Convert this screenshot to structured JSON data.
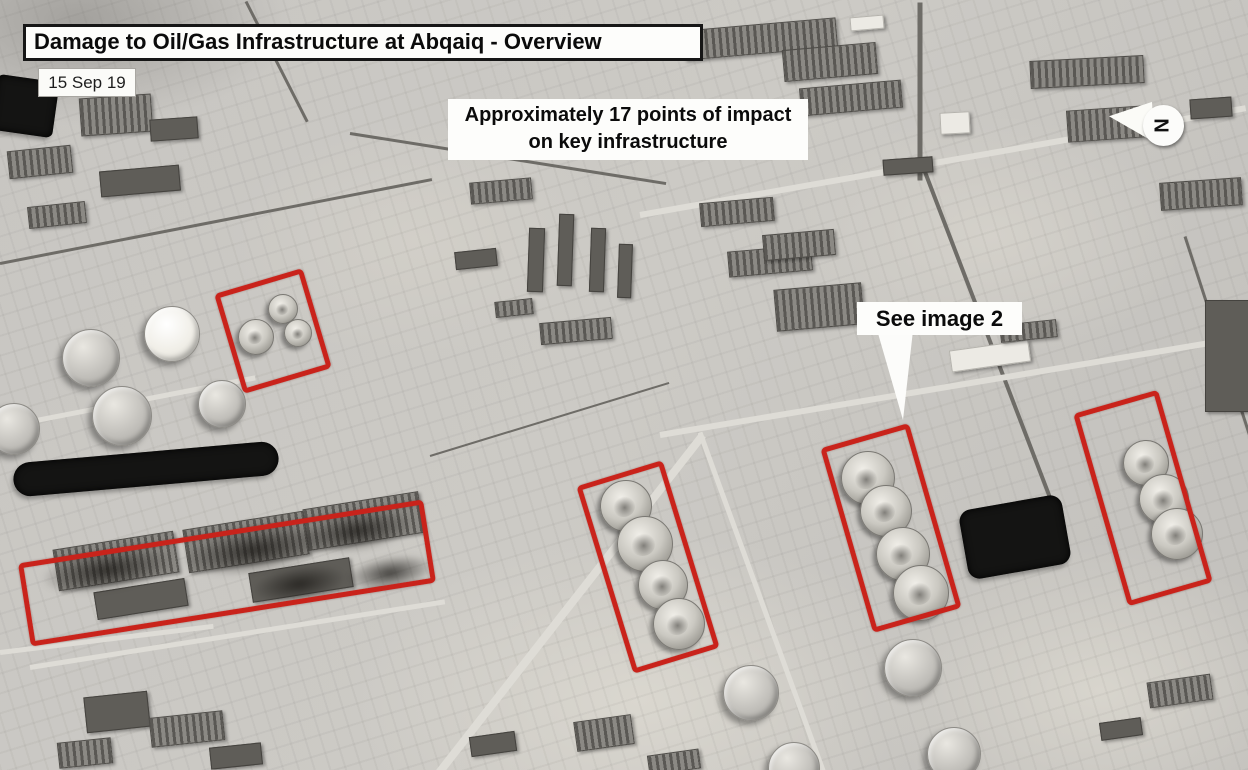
{
  "annotations": {
    "title": "Damage to Oil/Gas Infrastructure at Abqaiq - Overview",
    "date": "15 Sep 19",
    "impact_note_line1": "Approximately 17 points of impact",
    "impact_note_line2": "on key infrastructure",
    "see_image_label": "See image 2",
    "compass_letter": "N",
    "marker_color": "#c9231b"
  },
  "damage_markers": [
    {
      "id": "processing-area-northwest",
      "cx": 273,
      "cy": 331,
      "w": 92,
      "h": 104,
      "rot": -16.5
    },
    {
      "id": "stabilization-towers-row",
      "cx": 227,
      "cy": 573,
      "w": 410,
      "h": 84,
      "rot": -9
    },
    {
      "id": "spheroid-tanks-center",
      "cx": 648,
      "cy": 567,
      "w": 90,
      "h": 196,
      "rot": -17
    },
    {
      "id": "spheroid-tanks-east",
      "cx": 891,
      "cy": 528,
      "w": 92,
      "h": 192,
      "rot": -16
    },
    {
      "id": "spheroid-tanks-far-east",
      "cx": 1143,
      "cy": 498,
      "w": 88,
      "h": 200,
      "rot": -16
    }
  ],
  "scene": {
    "tanks": [
      {
        "x": 90,
        "y": 357,
        "r": 28
      },
      {
        "x": 171,
        "y": 333,
        "r": 27,
        "v": "bright"
      },
      {
        "x": 121,
        "y": 415,
        "r": 29
      },
      {
        "x": 221,
        "y": 403,
        "r": 23
      },
      {
        "x": 13,
        "y": 428,
        "r": 25
      },
      {
        "x": 750,
        "y": 692,
        "r": 27
      },
      {
        "x": 912,
        "y": 667,
        "r": 28
      },
      {
        "x": 953,
        "y": 753,
        "r": 26
      },
      {
        "x": 793,
        "y": 767,
        "r": 25
      }
    ],
    "domes": [
      {
        "x": 282,
        "y": 308,
        "r": 14
      },
      {
        "x": 255,
        "y": 336,
        "r": 17
      },
      {
        "x": 297,
        "y": 332,
        "r": 13
      },
      {
        "x": 625,
        "y": 505,
        "r": 25
      },
      {
        "x": 644,
        "y": 543,
        "r": 27
      },
      {
        "x": 662,
        "y": 584,
        "r": 24
      },
      {
        "x": 678,
        "y": 623,
        "r": 25
      },
      {
        "x": 867,
        "y": 477,
        "r": 26
      },
      {
        "x": 885,
        "y": 510,
        "r": 25
      },
      {
        "x": 902,
        "y": 553,
        "r": 26
      },
      {
        "x": 920,
        "y": 592,
        "r": 27
      },
      {
        "x": 1145,
        "y": 462,
        "r": 22
      },
      {
        "x": 1163,
        "y": 498,
        "r": 24
      },
      {
        "x": 1176,
        "y": 533,
        "r": 25
      }
    ],
    "ponds": [
      {
        "l": 13,
        "t": 452,
        "w": 266,
        "h": 34,
        "rot": -5,
        "br": 17
      },
      {
        "l": 963,
        "t": 502,
        "w": 104,
        "h": 70,
        "rot": -10,
        "br": 12
      },
      {
        "l": -6,
        "t": 78,
        "w": 62,
        "h": 56,
        "rot": 8,
        "br": 6
      }
    ],
    "smoke": [
      {
        "l": 40,
        "t": 548,
        "w": 135,
        "h": 44,
        "rot": -9
      },
      {
        "l": 180,
        "t": 526,
        "w": 150,
        "h": 48,
        "rot": -9
      },
      {
        "l": 300,
        "t": 510,
        "w": 115,
        "h": 42,
        "rot": -9
      },
      {
        "l": 252,
        "t": 566,
        "w": 95,
        "h": 36,
        "rot": -9
      },
      {
        "l": 345,
        "t": 556,
        "w": 90,
        "h": 34,
        "rot": -9
      }
    ],
    "buildings": [
      {
        "l": 80,
        "t": 96,
        "w": 70,
        "h": 36,
        "v": "striped",
        "rot": -4
      },
      {
        "l": 8,
        "t": 148,
        "w": 62,
        "h": 26,
        "v": "striped",
        "rot": -6
      },
      {
        "l": 100,
        "t": 168,
        "w": 78,
        "h": 24,
        "v": "dark",
        "rot": -5
      },
      {
        "l": 28,
        "t": 204,
        "w": 56,
        "h": 20,
        "v": "striped",
        "rot": -6
      },
      {
        "l": 150,
        "t": 118,
        "w": 46,
        "h": 20,
        "v": "dark",
        "rot": -4
      },
      {
        "l": 683,
        "t": 24,
        "w": 152,
        "h": 28,
        "v": "striped",
        "rot": -5
      },
      {
        "l": 783,
        "t": 46,
        "w": 92,
        "h": 30,
        "v": "striped",
        "rot": -5
      },
      {
        "l": 800,
        "t": 84,
        "w": 100,
        "h": 26,
        "v": "striped",
        "rot": -5
      },
      {
        "l": 850,
        "t": 16,
        "w": 32,
        "h": 12,
        "v": "light",
        "rot": -5
      },
      {
        "l": 700,
        "t": 200,
        "w": 72,
        "h": 22,
        "v": "striped",
        "rot": -5
      },
      {
        "l": 728,
        "t": 248,
        "w": 82,
        "h": 24,
        "v": "striped",
        "rot": -5
      },
      {
        "l": 775,
        "t": 286,
        "w": 86,
        "h": 40,
        "v": "striped",
        "rot": -5
      },
      {
        "l": 763,
        "t": 232,
        "w": 70,
        "h": 24,
        "v": "striped",
        "rot": -5
      },
      {
        "l": 528,
        "t": 228,
        "w": 14,
        "h": 62,
        "v": "dark",
        "rot": 2
      },
      {
        "l": 558,
        "t": 214,
        "w": 13,
        "h": 70,
        "v": "dark",
        "rot": 2
      },
      {
        "l": 590,
        "t": 228,
        "w": 13,
        "h": 62,
        "v": "dark",
        "rot": 2
      },
      {
        "l": 618,
        "t": 244,
        "w": 12,
        "h": 52,
        "v": "dark",
        "rot": 2
      },
      {
        "l": 540,
        "t": 320,
        "w": 70,
        "h": 20,
        "v": "striped",
        "rot": -5
      },
      {
        "l": 470,
        "t": 180,
        "w": 60,
        "h": 20,
        "v": "striped",
        "rot": -5
      },
      {
        "l": 455,
        "t": 250,
        "w": 40,
        "h": 16,
        "v": "dark",
        "rot": -6
      },
      {
        "l": 495,
        "t": 300,
        "w": 36,
        "h": 14,
        "v": "striped",
        "rot": -6
      },
      {
        "l": 1030,
        "t": 58,
        "w": 112,
        "h": 26,
        "v": "striped",
        "rot": -3
      },
      {
        "l": 1067,
        "t": 108,
        "w": 76,
        "h": 30,
        "v": "striped",
        "rot": -4
      },
      {
        "l": 940,
        "t": 112,
        "w": 28,
        "h": 20,
        "v": "light",
        "rot": -3
      },
      {
        "l": 883,
        "t": 158,
        "w": 48,
        "h": 14,
        "v": "dark",
        "rot": -4
      },
      {
        "l": 1160,
        "t": 180,
        "w": 80,
        "h": 26,
        "v": "striped",
        "rot": -4
      },
      {
        "l": 1205,
        "t": 300,
        "w": 44,
        "h": 110,
        "v": "dark",
        "rot": 0
      },
      {
        "l": 1190,
        "t": 98,
        "w": 40,
        "h": 18,
        "v": "dark",
        "rot": -4
      },
      {
        "l": 950,
        "t": 345,
        "w": 78,
        "h": 20,
        "v": "light",
        "rot": -8
      },
      {
        "l": 1000,
        "t": 322,
        "w": 55,
        "h": 16,
        "v": "striped",
        "rot": -6
      },
      {
        "l": 55,
        "t": 540,
        "w": 120,
        "h": 40,
        "v": "striped",
        "rot": -9
      },
      {
        "l": 185,
        "t": 520,
        "w": 120,
        "h": 42,
        "v": "striped",
        "rot": -9
      },
      {
        "l": 305,
        "t": 500,
        "w": 115,
        "h": 40,
        "v": "striped",
        "rot": -9
      },
      {
        "l": 95,
        "t": 585,
        "w": 90,
        "h": 26,
        "v": "dark",
        "rot": -9
      },
      {
        "l": 250,
        "t": 565,
        "w": 100,
        "h": 28,
        "v": "dark",
        "rot": -9
      },
      {
        "l": 85,
        "t": 694,
        "w": 62,
        "h": 34,
        "v": "dark",
        "rot": -6
      },
      {
        "l": 150,
        "t": 714,
        "w": 72,
        "h": 28,
        "v": "striped",
        "rot": -6
      },
      {
        "l": 58,
        "t": 740,
        "w": 52,
        "h": 24,
        "v": "striped",
        "rot": -6
      },
      {
        "l": 210,
        "t": 745,
        "w": 50,
        "h": 20,
        "v": "dark",
        "rot": -6
      },
      {
        "l": 470,
        "t": 734,
        "w": 44,
        "h": 18,
        "v": "dark",
        "rot": -8
      },
      {
        "l": 575,
        "t": 718,
        "w": 56,
        "h": 28,
        "v": "striped",
        "rot": -8
      },
      {
        "l": 648,
        "t": 752,
        "w": 50,
        "h": 18,
        "v": "striped",
        "rot": -8
      },
      {
        "l": 1148,
        "t": 678,
        "w": 62,
        "h": 24,
        "v": "striped",
        "rot": -8
      },
      {
        "l": 1100,
        "t": 720,
        "w": 40,
        "h": 16,
        "v": "dark",
        "rot": -8
      }
    ],
    "lines": [
      {
        "l": 0,
        "t": 262,
        "w": 440,
        "h": 3,
        "rot": -11,
        "v": "dark"
      },
      {
        "l": 350,
        "t": 132,
        "w": 320,
        "h": 3,
        "rot": 9,
        "v": "dark"
      },
      {
        "l": 920,
        "t": 0,
        "w": 178,
        "h": 5,
        "rot": 90,
        "v": "dark"
      },
      {
        "l": 925,
        "t": 170,
        "w": 386,
        "h": 4,
        "rot": 69,
        "v": "dark"
      },
      {
        "l": 246,
        "t": 0,
        "w": 135,
        "h": 3,
        "rot": 63,
        "v": "dark"
      },
      {
        "l": 1185,
        "t": 235,
        "w": 430,
        "h": 3,
        "rot": 72,
        "v": "dark"
      },
      {
        "l": 430,
        "t": 455,
        "w": 250,
        "h": 2,
        "rot": -17,
        "v": "dark"
      },
      {
        "l": 640,
        "t": 212,
        "w": 615,
        "h": 6,
        "rot": -10,
        "v": "light"
      },
      {
        "l": 0,
        "t": 425,
        "w": 260,
        "h": 5,
        "rot": -11,
        "v": "light"
      },
      {
        "l": 438,
        "t": 770,
        "w": 430,
        "h": 8,
        "rot": -52,
        "v": "light"
      },
      {
        "l": 660,
        "t": 432,
        "w": 600,
        "h": 6,
        "rot": -9.5,
        "v": "light"
      },
      {
        "l": 0,
        "t": 650,
        "w": 215,
        "h": 5,
        "rot": -7,
        "v": "light"
      },
      {
        "l": 30,
        "t": 665,
        "w": 420,
        "h": 5,
        "rot": -9,
        "v": "light"
      },
      {
        "l": 700,
        "t": 430,
        "w": 360,
        "h": 5,
        "rot": 70,
        "v": "light"
      }
    ]
  }
}
